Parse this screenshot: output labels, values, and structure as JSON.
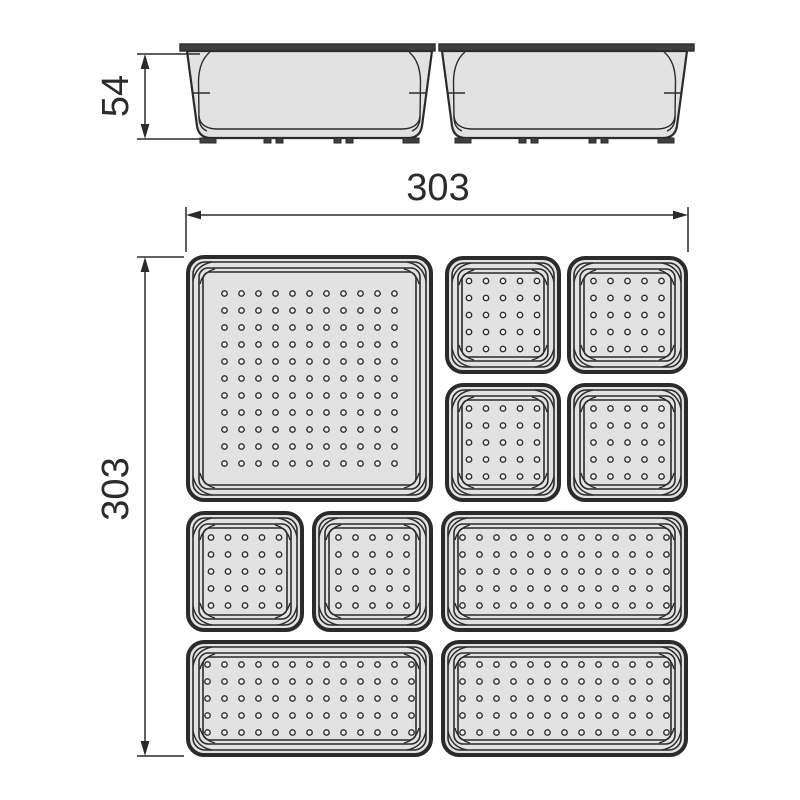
{
  "drawing": {
    "title": "drawer-organizer-tray-set-technical-drawing",
    "colors": {
      "background": "#ffffff",
      "line": "#2b2b2b",
      "fill": "#e2e2e2",
      "rim": "#3f3f3f",
      "dot_fill": "#f0f0f0"
    },
    "dimensions": {
      "side_height": "54",
      "plan_width": "303",
      "plan_depth": "303"
    },
    "side_view": {
      "rim_top": 44,
      "rim_h": 7,
      "body_top": 51,
      "body_bottom": 138,
      "taper": 11,
      "feet_h": 5,
      "trays": [
        {
          "x": 186,
          "w": 247,
          "rim_left": 6,
          "rim_right": 2
        },
        {
          "x": 441,
          "w": 247,
          "rim_left": 2,
          "rim_right": 6
        }
      ]
    },
    "plan_view": {
      "dot_spacing": 17,
      "trays": [
        {
          "name": "large-square-tray",
          "x": 186,
          "y": 255,
          "w": 247,
          "h": 247,
          "dot_cols": 11,
          "dot_rows": 11
        },
        {
          "name": "small-square-tray-1",
          "x": 445,
          "y": 256,
          "w": 116,
          "h": 118,
          "dot_cols": 5,
          "dot_rows": 5
        },
        {
          "name": "small-square-tray-2",
          "x": 567,
          "y": 256,
          "w": 121,
          "h": 118,
          "dot_cols": 5,
          "dot_rows": 5
        },
        {
          "name": "small-square-tray-3",
          "x": 445,
          "y": 383,
          "w": 116,
          "h": 119,
          "dot_cols": 5,
          "dot_rows": 5
        },
        {
          "name": "small-square-tray-4",
          "x": 567,
          "y": 383,
          "w": 121,
          "h": 119,
          "dot_cols": 5,
          "dot_rows": 5
        },
        {
          "name": "small-square-tray-5",
          "x": 186,
          "y": 511,
          "w": 118,
          "h": 121,
          "dot_cols": 5,
          "dot_rows": 5
        },
        {
          "name": "small-square-tray-6",
          "x": 312,
          "y": 511,
          "w": 121,
          "h": 121,
          "dot_cols": 5,
          "dot_rows": 5
        },
        {
          "name": "wide-tray-1",
          "x": 441,
          "y": 511,
          "w": 247,
          "h": 121,
          "dot_cols": 13,
          "dot_rows": 5
        },
        {
          "name": "wide-tray-2",
          "x": 186,
          "y": 640,
          "w": 247,
          "h": 117,
          "dot_cols": 13,
          "dot_rows": 5
        },
        {
          "name": "wide-tray-3",
          "x": 441,
          "y": 640,
          "w": 247,
          "h": 117,
          "dot_cols": 13,
          "dot_rows": 5
        }
      ]
    }
  }
}
